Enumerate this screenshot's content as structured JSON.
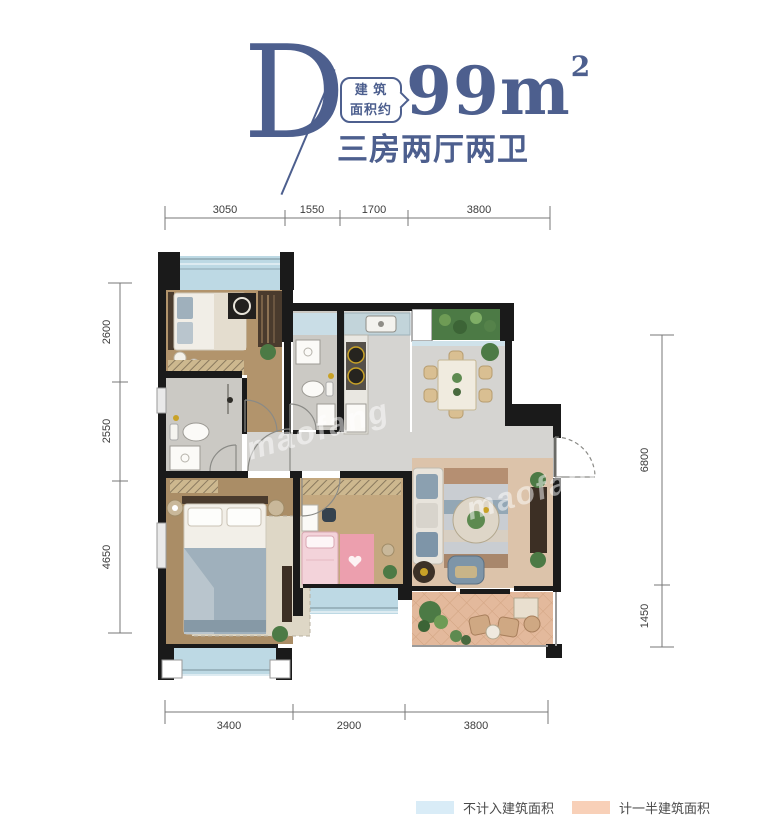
{
  "header": {
    "plan_letter": "D",
    "area_badge": {
      "line1": "建 筑",
      "line2": "面积约"
    },
    "area_value": "99m",
    "area_unit_sup": "2",
    "subtitle": "三房两厅两卫",
    "accent_color": "#4d5f8e"
  },
  "dimensions": {
    "top": [
      "3050",
      "1550",
      "1700",
      "3800"
    ],
    "left": [
      "2600",
      "2550",
      "4650"
    ],
    "right": [
      "6800",
      "1450"
    ],
    "bottom": [
      "3400",
      "2900",
      "3800"
    ]
  },
  "legend": {
    "items": [
      {
        "label": "不计入建筑面积",
        "color": "#d9ecf7"
      },
      {
        "label": "计一半建筑面积",
        "color": "#f8d0b8"
      }
    ]
  },
  "watermark": {
    "text": "maofang"
  },
  "colors": {
    "wall": "#1a1a1a",
    "balcony_blue": "#bdd9e4",
    "window_blue": "#c9dde6",
    "terrace_peach": "#e3b99c",
    "living_tan": "#dcc3aa",
    "wood_bedroom2": "#b2946c",
    "wood_master": "#aa8d66",
    "wood_kids": "#c4a87f",
    "tile_gray": "#d5d4d1",
    "bath_gray": "#cbc9c4",
    "planter_green": "#4c7a45"
  }
}
